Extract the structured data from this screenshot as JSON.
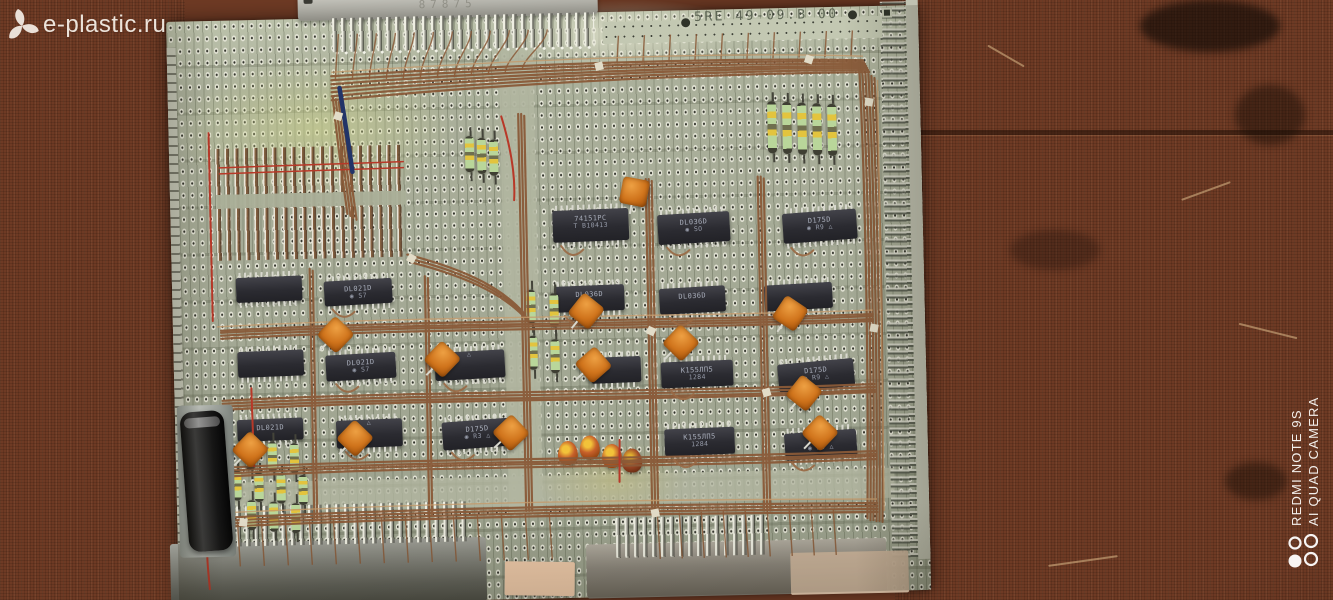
{
  "photo": {
    "subject": "Wire-wrapped prototype circuit board with Soviet and East-German DIP ICs on a brown workbench",
    "board_marking": "5RE 49-09.B 00",
    "connector_stamp": "87875"
  },
  "watermark": {
    "site": "e-plastic.ru"
  },
  "camera_watermark": {
    "line1": "REDMI NOTE 9S",
    "line2": "AI QUAD CAMERA"
  },
  "colors": {
    "board": "#a9ae99",
    "bench_left": "#8e4b36",
    "bench_right": "#5e341f",
    "wire": "#8a5a38",
    "cap_orange": "#d0741c",
    "chip_body": "#2b2b31",
    "watermark_text": "#f3ede5"
  },
  "components": {
    "chips": [
      {
        "x": 382,
        "y": 197,
        "w": 76,
        "h": 32,
        "r": -1,
        "l1": "74151PC",
        "l2": "T B10413"
      },
      {
        "x": 487,
        "y": 203,
        "w": 72,
        "h": 30,
        "r": -2,
        "l1": "DL036D",
        "l2": "◉ SO"
      },
      {
        "x": 612,
        "y": 204,
        "w": 74,
        "h": 30,
        "r": -3,
        "l1": "D175D",
        "l2": "◉ R9 △"
      },
      {
        "x": 64,
        "y": 257,
        "w": 66,
        "h": 25,
        "r": -1,
        "l1": "",
        "l2": ""
      },
      {
        "x": 152,
        "y": 262,
        "w": 68,
        "h": 25,
        "r": -2,
        "l1": "DL021D",
        "l2": "◉ S7"
      },
      {
        "x": 382,
        "y": 273,
        "w": 70,
        "h": 26,
        "r": -1,
        "l1": "DL036D",
        "l2": ""
      },
      {
        "x": 487,
        "y": 277,
        "w": 66,
        "h": 26,
        "r": -2,
        "l1": "DL036D",
        "l2": ""
      },
      {
        "x": 592,
        "y": 276,
        "w": 68,
        "h": 26,
        "r": -2,
        "l1": "",
        "l2": ""
      },
      {
        "x": 64,
        "y": 331,
        "w": 66,
        "h": 26,
        "r": -1,
        "l1": "",
        "l2": ""
      },
      {
        "x": 152,
        "y": 336,
        "w": 70,
        "h": 26,
        "r": -2,
        "l1": "DL021D",
        "l2": "◉ S7"
      },
      {
        "x": 261,
        "y": 336,
        "w": 70,
        "h": 28,
        "r": -2,
        "l1": "",
        "l2": "△"
      },
      {
        "x": 417,
        "y": 345,
        "w": 50,
        "h": 26,
        "r": -1,
        "l1": "",
        "l2": ""
      },
      {
        "x": 487,
        "y": 351,
        "w": 72,
        "h": 26,
        "r": -1,
        "l1": "К155ЛП5",
        "l2": "1284"
      },
      {
        "x": 604,
        "y": 354,
        "w": 76,
        "h": 28,
        "r": -4,
        "l1": "D175D",
        "l2": "◉ R9 △"
      },
      {
        "x": 62,
        "y": 399,
        "w": 66,
        "h": 22,
        "r": -1,
        "l1": "DL021D",
        "l2": ""
      },
      {
        "x": 161,
        "y": 402,
        "w": 66,
        "h": 28,
        "r": -1,
        "l1": "",
        "l2": "△"
      },
      {
        "x": 267,
        "y": 405,
        "w": 70,
        "h": 28,
        "r": -3,
        "l1": "D175D",
        "l2": "◉ R3 △"
      },
      {
        "x": 489,
        "y": 418,
        "w": 70,
        "h": 27,
        "r": -1,
        "l1": "К155ЛП5",
        "l2": "1284"
      },
      {
        "x": 609,
        "y": 424,
        "w": 72,
        "h": 27,
        "r": -3,
        "l1": "D175D",
        "l2": "◉ R9 △"
      }
    ],
    "orange_caps": [
      [
        451,
        167,
        12
      ],
      [
        149,
        303,
        45
      ],
      [
        255,
        330,
        45
      ],
      [
        400,
        285,
        40
      ],
      [
        494,
        319,
        45
      ],
      [
        616,
        372,
        40
      ],
      [
        166,
        407,
        45
      ],
      [
        631,
        412,
        45
      ],
      [
        61,
        416,
        45
      ],
      [
        406,
        339,
        50
      ],
      [
        604,
        292,
        35
      ],
      [
        322,
        405,
        48
      ]
    ],
    "drop_caps": [
      [
        382,
        428,
        ""
      ],
      [
        404,
        423,
        ""
      ],
      [
        426,
        432,
        ""
      ],
      [
        446,
        437,
        "dk"
      ]
    ],
    "resistors": [
      [
        296,
        121,
        36
      ],
      [
        308,
        123,
        36
      ],
      [
        320,
        125,
        36
      ],
      [
        599,
        93,
        52
      ],
      [
        614,
        94,
        52
      ],
      [
        629,
        95,
        52
      ],
      [
        644,
        96,
        52
      ],
      [
        659,
        97,
        52
      ],
      [
        354,
        276,
        34
      ],
      [
        377,
        280,
        34
      ],
      [
        355,
        322,
        34
      ],
      [
        377,
        326,
        34
      ],
      [
        70,
        420,
        30
      ],
      [
        92,
        422,
        30
      ],
      [
        114,
        424,
        30
      ],
      [
        56,
        450,
        30
      ],
      [
        78,
        452,
        30
      ],
      [
        100,
        454,
        30
      ],
      [
        122,
        456,
        30
      ],
      [
        70,
        480,
        30
      ],
      [
        92,
        482,
        30
      ],
      [
        114,
        484,
        30
      ]
    ]
  }
}
